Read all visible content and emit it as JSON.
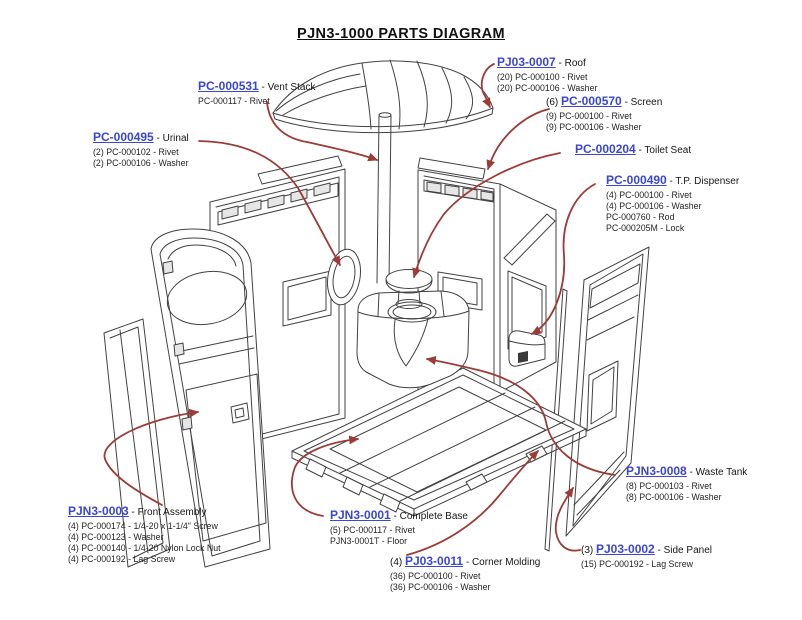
{
  "title": "PJN3-1000 PARTS DIAGRAM",
  "colors": {
    "link": "#3a46d4",
    "leader": "#9d3b36",
    "ink": "#424242"
  },
  "labels": {
    "roof": {
      "code": "PJ03-0007",
      "name": " - Roof",
      "parts": [
        "(20) PC-000100 - Rivet",
        "(20) PC-000106 - Washer"
      ]
    },
    "vent_stack": {
      "code": "PC-000531",
      "name": " - Vent Stack",
      "parts": [
        "PC-000117 - Rivet"
      ]
    },
    "screen": {
      "prefix": "(6) ",
      "code": "PC-000570",
      "name": " - Screen",
      "parts": [
        "(9) PC-000100 - Rivet",
        "(9) PC-000106 - Washer"
      ]
    },
    "urinal": {
      "code": "PC-000495",
      "name": " - Urinal",
      "parts": [
        "(2) PC-000102 - Rivet",
        "(2) PC-000106 - Washer"
      ]
    },
    "toilet_seat": {
      "code": "PC-000204",
      "name": " - Toilet Seat",
      "parts": []
    },
    "tp_dispenser": {
      "code": "PC-000490",
      "name": " - T.P. Dispenser",
      "parts": [
        "(4) PC-000100 - Rivet",
        "(4) PC-000106 - Washer",
        "PC-000760 - Rod",
        "PC-000205M - Lock"
      ]
    },
    "waste_tank": {
      "code": "PJN3-0008",
      "name": " - Waste Tank",
      "parts": [
        "(8) PC-000103 - Rivet",
        "(8) PC-000106 - Washer"
      ]
    },
    "front_assembly": {
      "code": "PJN3-0003",
      "name": " - Front Assembly",
      "parts": [
        "(4) PC-000174 - 1/4-20 x 1-1/4\" Screw",
        "(4) PC-000123 - Washer",
        "(4) PC-000140 - 1/4-20 Nylon Lock Nut",
        "(4) PC-000192 - Lag Screw"
      ]
    },
    "complete_base": {
      "code": "PJN3-0001",
      "name": " - Complete Base",
      "parts": [
        "(5) PC-000117 - Rivet",
        "PJN3-0001T - Floor"
      ]
    },
    "corner_molding": {
      "prefix": "(4) ",
      "code": "PJ03-0011",
      "name": " - Corner Molding",
      "parts": [
        "(36) PC-000100 - Rivet",
        "(36) PC-000106 - Washer"
      ]
    },
    "side_panel": {
      "prefix": "(3) ",
      "code": "PJ03-0002",
      "name": " - Side Panel",
      "parts": [
        "(15) PC-000192 - Lag Screw"
      ]
    }
  }
}
